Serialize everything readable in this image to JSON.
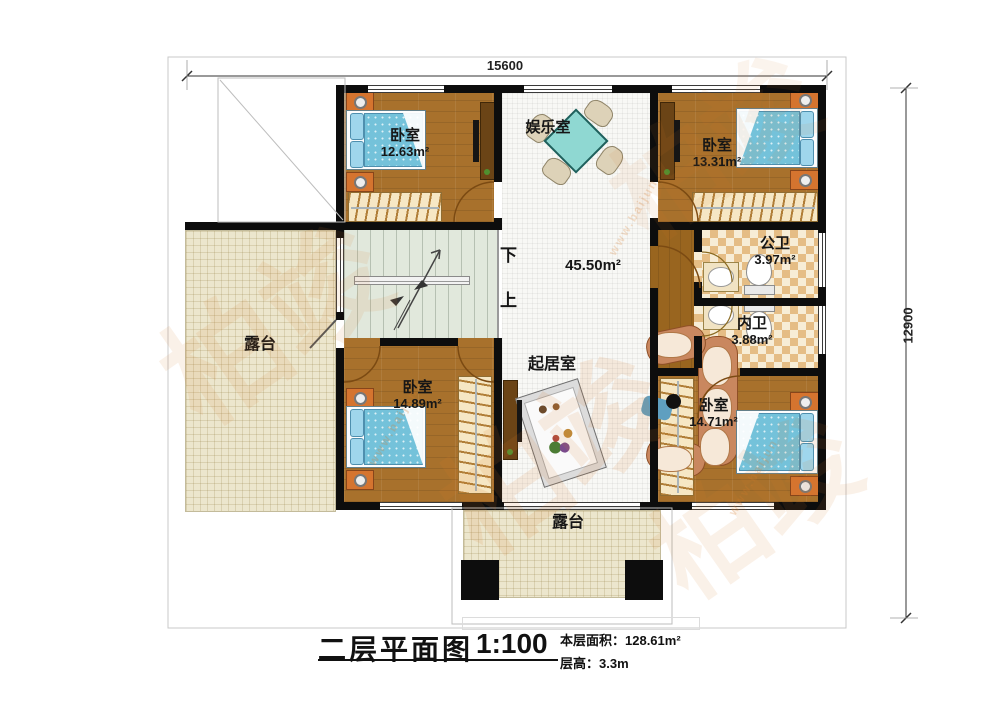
{
  "watermark": {
    "brand": "柏竣",
    "url": "www.baijun"
  },
  "dimensions": {
    "top": "15600",
    "right": "12900"
  },
  "stairs": {
    "down": "下",
    "up": "上"
  },
  "rooms": {
    "bedroom_top_left": {
      "name": "卧室",
      "area": "12.63m²"
    },
    "entertainment": {
      "name": "娱乐室"
    },
    "bedroom_top_right": {
      "name": "卧室",
      "area": "13.31m²"
    },
    "public_bath": {
      "name": "公卫",
      "area": "3.97m²"
    },
    "private_bath": {
      "name": "内卫",
      "area": "3.88m²"
    },
    "hall": {
      "area": "45.50m²"
    },
    "living": {
      "name": "起居室"
    },
    "bedroom_bottom_left": {
      "name": "卧室",
      "area": "14.89m²"
    },
    "bedroom_bottom_right": {
      "name": "卧室",
      "area": "14.71m²"
    },
    "terrace_left": {
      "name": "露台"
    },
    "terrace_bottom": {
      "name": "露台"
    }
  },
  "title_block": {
    "title": "二层平面图",
    "scale": "1:100",
    "floor_area": "本层面积：128.61m²",
    "floor_height": "层高：3.3m"
  }
}
